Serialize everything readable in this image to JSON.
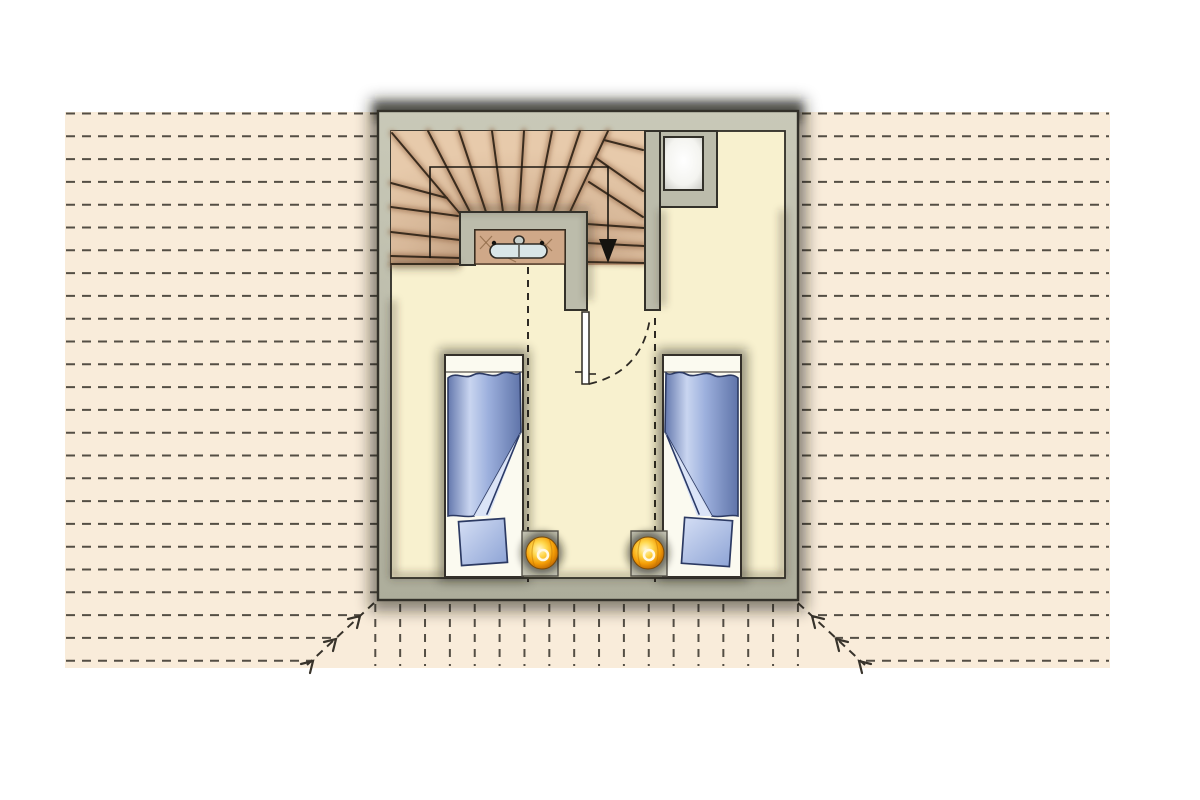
{
  "meta": {
    "title": "Attic floor plan with winder staircase and two single beds, set in a roof plan with dashed tile hatching",
    "drawing_type": "architectural-floor-plan",
    "elements": [
      "roof plan hatching",
      "hip lines with slope arrows",
      "exterior walls",
      "winder staircase",
      "stairwell parapet",
      "radiator seen on lower floor",
      "walking line with down arrow",
      "door with swing arc",
      "chimney with flue",
      "two single beds with blankets and pillows",
      "two glowing bedside lamps on nightstands",
      "headroom guide dashed lines"
    ]
  },
  "palette": {
    "page_bg": "#ffffff",
    "roof_field": "#f9ecda",
    "hatch": "#38332b",
    "wall_fill": "#bcbcab",
    "wall_line": "#33312a",
    "floor": "#f8f1cf",
    "floor_line": "#2f2d26",
    "stair_fill": "#e7caab",
    "stair_line": "#3a2c1e",
    "stair_shade": "#8a5a38",
    "cavity": "#cfa888",
    "radiator": "#d9e6e8",
    "door_leaf": "#ffffff",
    "bed_base": "#fbfaf0",
    "blanket_dark": "#5f74a9",
    "blanket_light": "#c9d5f0",
    "pillow": "#a9bce2",
    "nightstand": "#c6c5b4",
    "lamp_bright": "#ffd84d",
    "lamp_mid": "#f59f07",
    "guide_dash": "#2e2a24",
    "shadow": "#15130f"
  },
  "roof": {
    "field": [
      65,
      112,
      1045,
      556
    ],
    "hatch_horizontal": {
      "x1": 66,
      "x2": 1109,
      "y0": 113.5,
      "step": 22.8,
      "count": 25,
      "dash": "9 7",
      "width": 2,
      "opacity": 0.85
    },
    "hatch_vertical": {
      "y1": 604,
      "y2": 666,
      "x0": 375.3,
      "step": 24.86,
      "count": 18,
      "dash": "8 7",
      "width": 2,
      "opacity": 0.85
    },
    "hips": [
      {
        "line": [
          374,
          603,
          307,
          665
        ],
        "chevrons": [
          [
            360,
            616
          ],
          [
            336,
            639
          ],
          [
            313,
            661
          ]
        ],
        "dir": -1
      },
      {
        "line": [
          798,
          603,
          865,
          665
        ],
        "chevrons": [
          [
            812,
            616
          ],
          [
            836,
            639
          ],
          [
            859,
            661
          ]
        ],
        "dir": 1
      }
    ]
  },
  "building": {
    "outer": [
      378,
      111,
      420,
      489
    ],
    "floor": [
      391,
      131,
      394,
      447
    ]
  },
  "divider_wall": [
    645,
    131,
    15,
    179
  ],
  "chimney": {
    "frame": [
      660,
      131,
      57,
      76
    ],
    "flue": [
      664,
      137,
      39,
      53
    ]
  },
  "stair": {
    "base": [
      391,
      131,
      254,
      134
    ],
    "well_path": "M460,265 L460,212 L587,212 L587,310 L565,310 L565,230 L475,230 L475,265 Z",
    "cavity": [
      475,
      230,
      90,
      34
    ],
    "tread_lines": [
      [
        392,
        133,
        462,
        216
      ],
      [
        391,
        183,
        447,
        198
      ],
      [
        391,
        207,
        458,
        216
      ],
      [
        391,
        232,
        460,
        240
      ],
      [
        391,
        256,
        460,
        258
      ],
      [
        391,
        264,
        460,
        264
      ],
      [
        428,
        131,
        470,
        212
      ],
      [
        459,
        131,
        486,
        212
      ],
      [
        492,
        131,
        503,
        212
      ],
      [
        524,
        131,
        519,
        212
      ],
      [
        552,
        131,
        536,
        212
      ],
      [
        580,
        131,
        553,
        212
      ],
      [
        608,
        131,
        570,
        212
      ],
      [
        604,
        140,
        643,
        150
      ],
      [
        596,
        158,
        643,
        191
      ],
      [
        589,
        182,
        643,
        217
      ],
      [
        587,
        224,
        644,
        228
      ],
      [
        587,
        243,
        644,
        246
      ],
      [
        587,
        262,
        644,
        263
      ]
    ],
    "walk_line": {
      "points": "430,258 430,167 608,167 608,241",
      "arrow_points": "599,239 617,239 608,263"
    }
  },
  "radiator": {
    "body": [
      490,
      244,
      57,
      14
    ],
    "valve": [
      514,
      236,
      10,
      9
    ],
    "divider_x": 519,
    "dots": [
      [
        494,
        243
      ],
      [
        542,
        243
      ]
    ]
  },
  "cavity_marks": [
    [
      480,
      236,
      492,
      249
    ],
    [
      492,
      236,
      480,
      249
    ],
    [
      540,
      239,
      552,
      251
    ],
    [
      552,
      239,
      540,
      251
    ],
    [
      508,
      258,
      516,
      262
    ]
  ],
  "door": {
    "leaf": [
      582,
      312,
      7,
      72
    ],
    "swing": "M589,384 Q642,372 650,318",
    "ticks": [
      [
        575,
        372,
        582,
        372
      ],
      [
        589,
        374,
        596,
        374
      ]
    ]
  },
  "guides": [
    [
      528,
      267,
      528,
      582
    ],
    [
      655,
      318,
      655,
      582
    ]
  ],
  "inner_shadow_lines": [
    [
      393,
      300,
      393,
      576
    ],
    [
      391,
      576,
      785,
      576
    ],
    [
      783,
      210,
      783,
      576
    ],
    [
      662,
      210,
      662,
      306
    ],
    [
      391,
      266,
      459,
      266
    ],
    [
      458,
      209,
      589,
      209
    ],
    [
      589,
      214,
      589,
      300
    ]
  ],
  "beds": {
    "left": {
      "frame": [
        445,
        355,
        78,
        222
      ],
      "band": [
        446,
        372,
        522,
        372
      ],
      "blanket": "M448,378 C456,371 464,380 473,375 C482,370 491,379 500,374 C509,369 515,377 520,373 L521,432 L474,516 C465,518 456,514 448,516 Z",
      "fold": "M521,432 L474,516 L489,516 Z",
      "crease": [
        519,
        436,
        487,
        514
      ],
      "pillow": {
        "transform": "translate(483 542) rotate(-4)",
        "x": -23,
        "y": -22,
        "w": 46,
        "h": 44
      }
    },
    "right": {
      "frame": [
        663,
        355,
        78,
        222
      ],
      "band": [
        664,
        372,
        740,
        372
      ],
      "blanket": "M738,378 C730,371 722,380 713,375 C704,370 695,379 686,374 C677,369 671,377 666,373 L665,432 L712,516 C721,518 730,514 738,516 Z",
      "fold": "M665,432 L712,516 L697,516 Z",
      "crease": [
        667,
        436,
        699,
        514
      ],
      "pillow": {
        "transform": "translate(707 542) rotate(4)",
        "x": -24,
        "y": -23,
        "w": 48,
        "h": 46
      }
    }
  },
  "nightstands": [
    [
      522,
      531,
      36,
      45
    ],
    [
      631,
      531,
      36,
      45
    ]
  ],
  "lamps": [
    {
      "transform": "translate(542 553)",
      "r": 16
    },
    {
      "transform": "translate(648 553)",
      "r": 16
    }
  ]
}
